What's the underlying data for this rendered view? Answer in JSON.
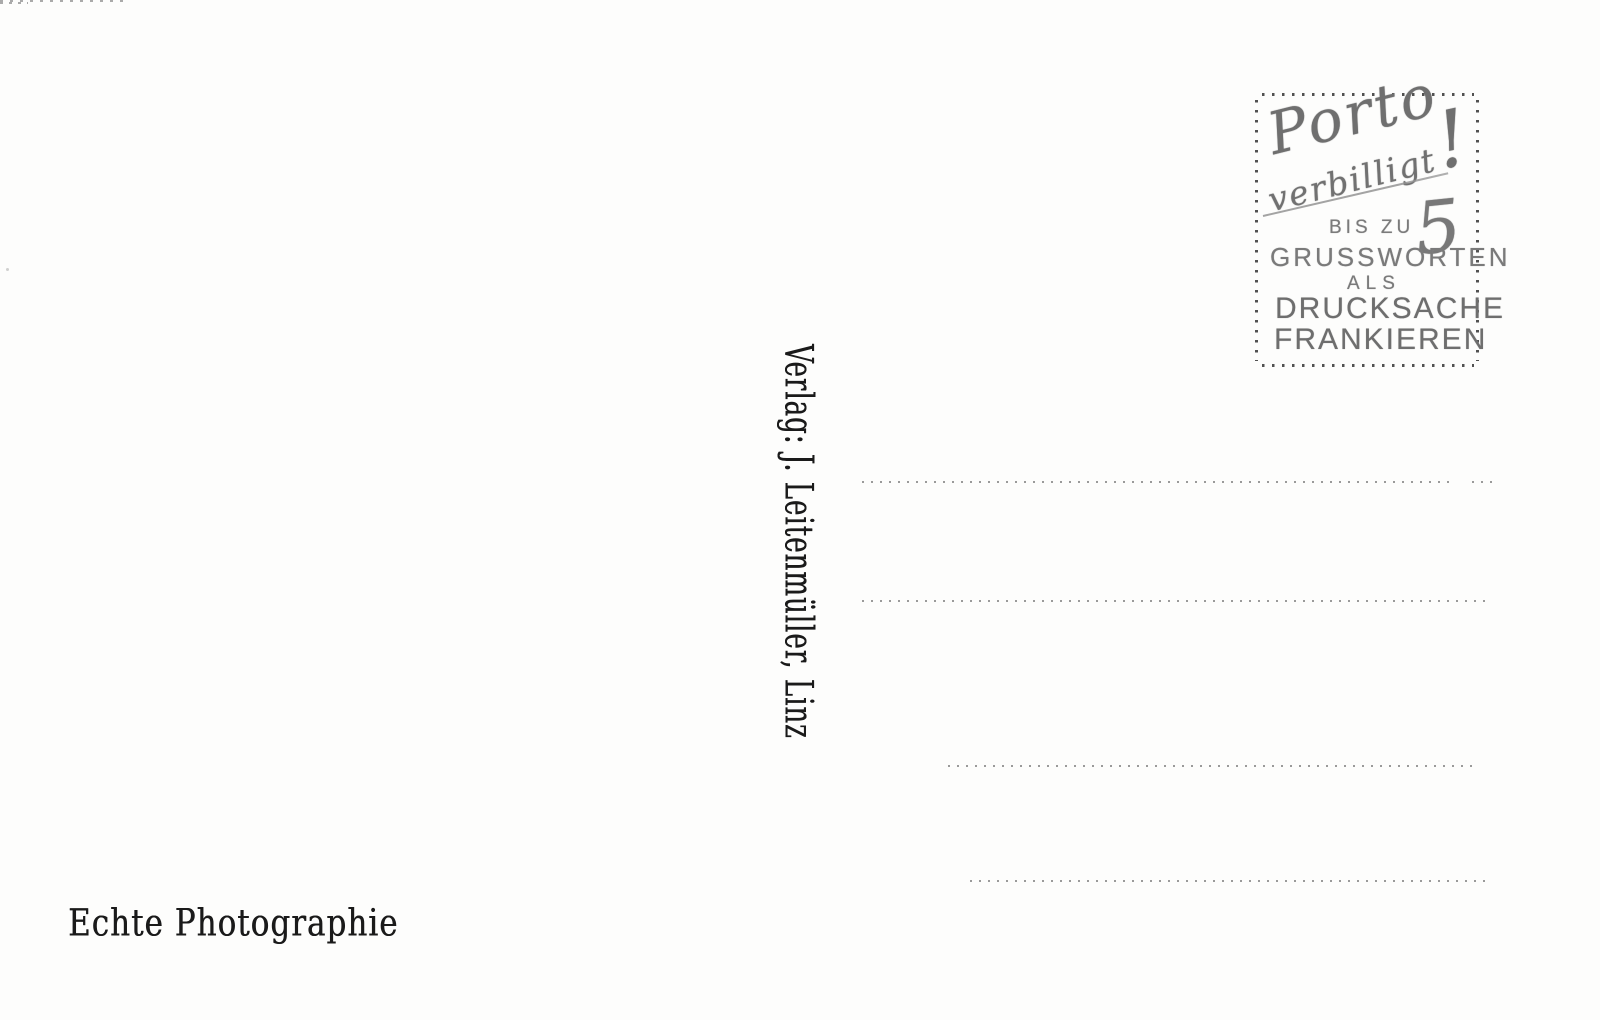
{
  "postcard": {
    "publisher_line": "Verlag: J. Leitenmüller, Linz",
    "photo_note": "Echte Photographie",
    "stamp": {
      "script_top": "Porto",
      "script_bottom": "verbilligt",
      "exclamation": "!",
      "bis_zu": "BIS ZU",
      "number": "5",
      "grussworten": "GRUSSWORTEN",
      "als": "ALS",
      "drucksache": "DRUCKSACHE",
      "frankieren": "FRANKIEREN"
    },
    "address_line_count": 4,
    "colors": {
      "paper": "#fdfdfc",
      "print_ink": "#1a1a1a",
      "stamp_ink": "#767676",
      "dotted_line": "#8f8f8f",
      "stamp_border_dots": "#333333"
    }
  }
}
